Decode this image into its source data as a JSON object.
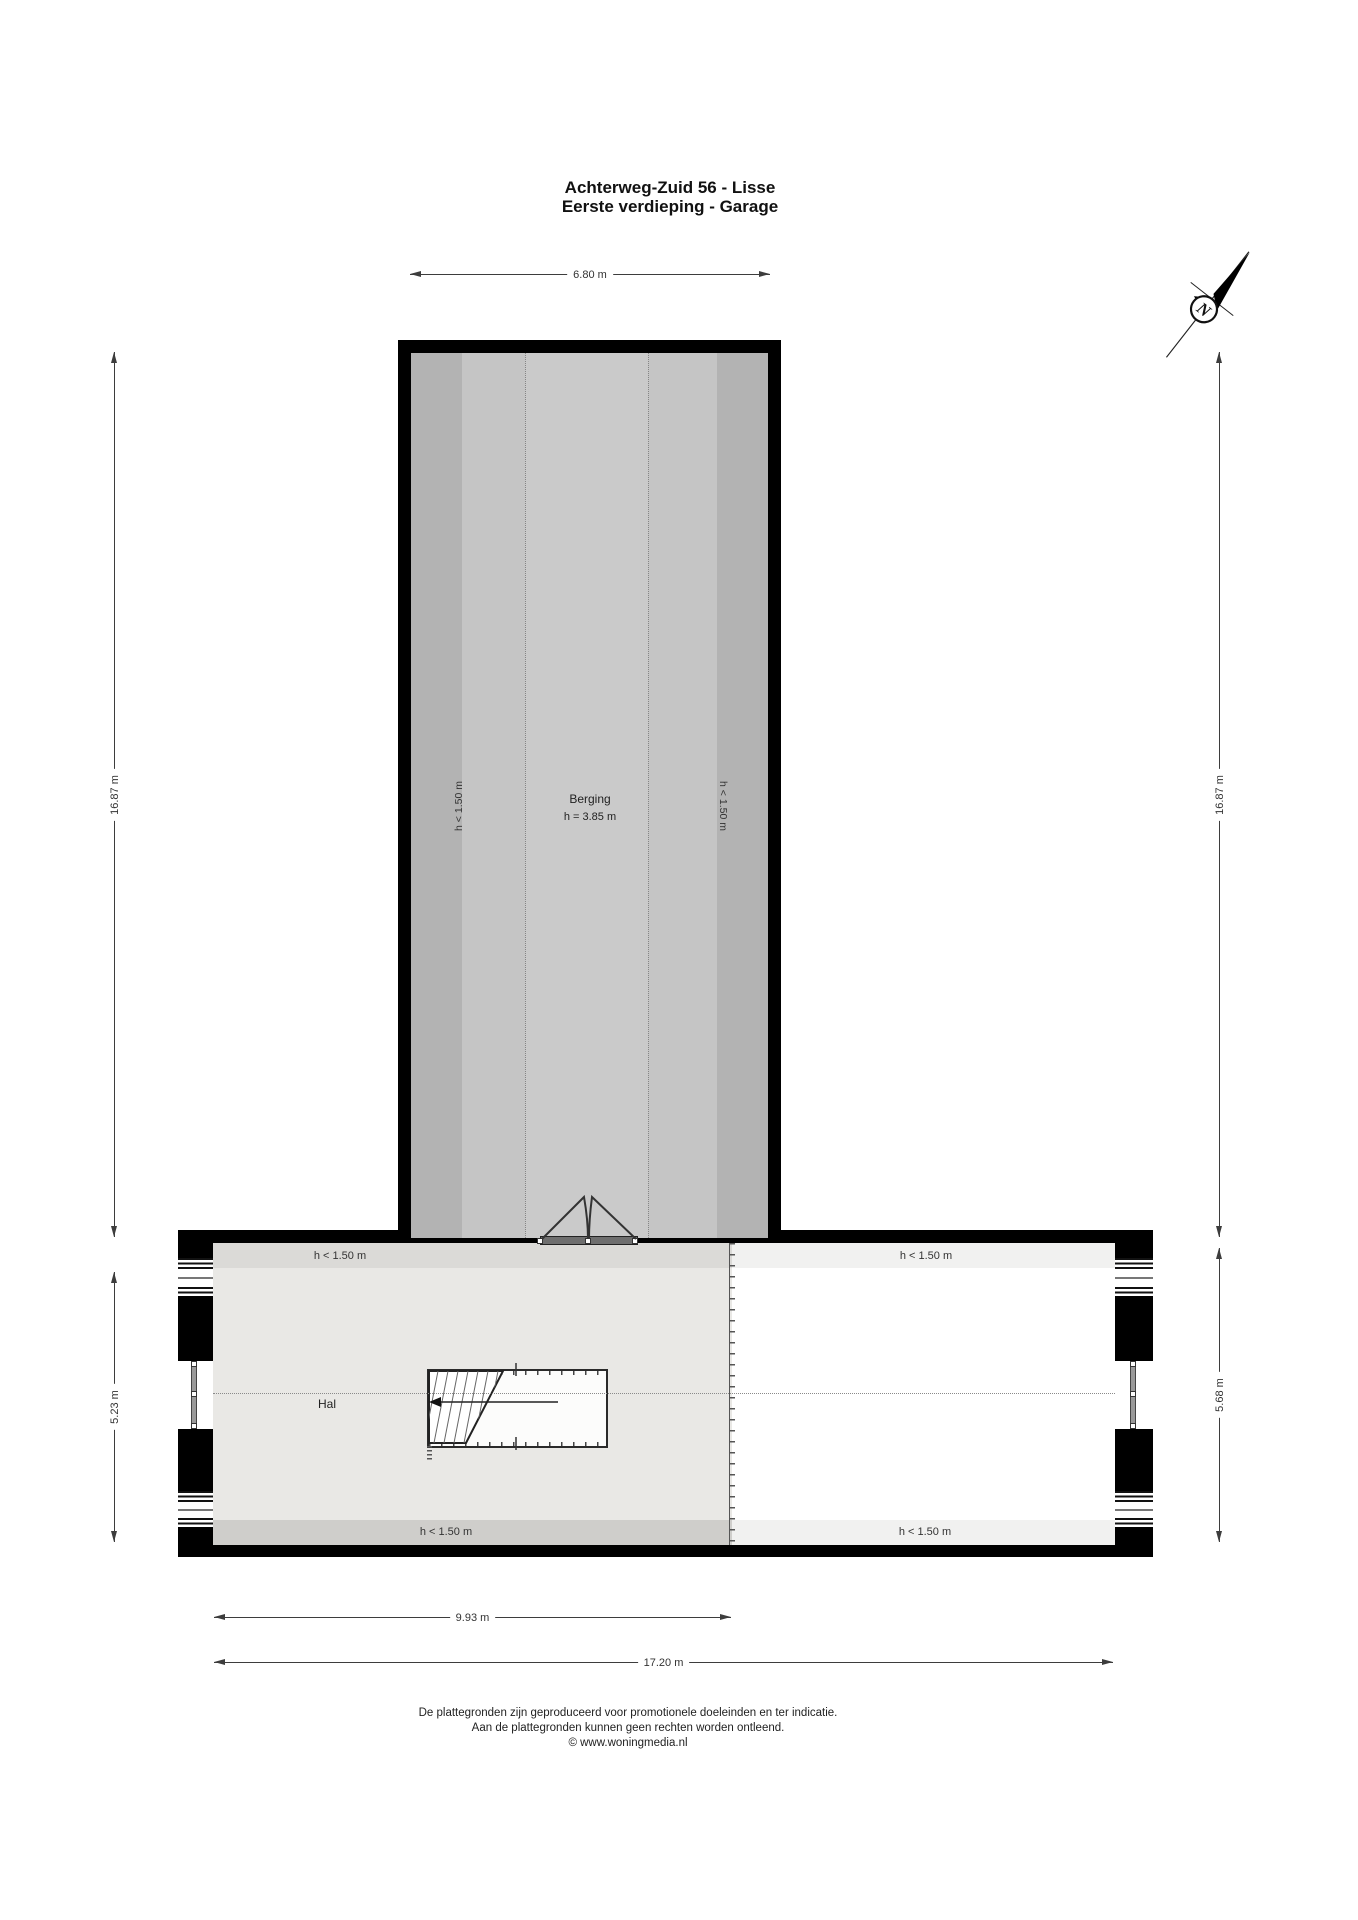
{
  "title": {
    "line1": "Achterweg-Zuid 56 - Lisse",
    "line2": "Eerste verdieping - Garage"
  },
  "compass": {
    "north_label": "N"
  },
  "rooms": {
    "berging": {
      "label": "Berging",
      "ceiling_height": "h = 3.85 m"
    },
    "hal": {
      "label": "Hal"
    }
  },
  "labels": {
    "low_clearance": "h < 1.50 m"
  },
  "dimensions": {
    "top_width": "6.80 m",
    "left_height": "16.87 m",
    "right_height": "16.87 m",
    "left_lower_height": "5.23 m",
    "right_lower_height": "5.68 m",
    "bottom_inner_width": "9.93 m",
    "bottom_total_width": "17.20 m"
  },
  "footer": {
    "line1": "De plattegronden zijn geproduceerd voor promotionele doeleinden en ter indicatie.",
    "line2": "Aan de plattegronden kunnen geen rechten worden ontleend.",
    "line3": "© www.woningmedia.nl"
  },
  "colors": {
    "wall": "#000000",
    "berging_floor": "#cacaca",
    "berging_mid_band": "#c5c5c5",
    "berging_low_band": "#b3b3b3",
    "hal_floor": "#e9e8e5",
    "hal_low_strip_top": "#dbdad7",
    "hal_low_strip_bottom": "#cfcecb",
    "garage_floor": "#ffffff",
    "garage_low_strip": "#f1f1f0"
  }
}
